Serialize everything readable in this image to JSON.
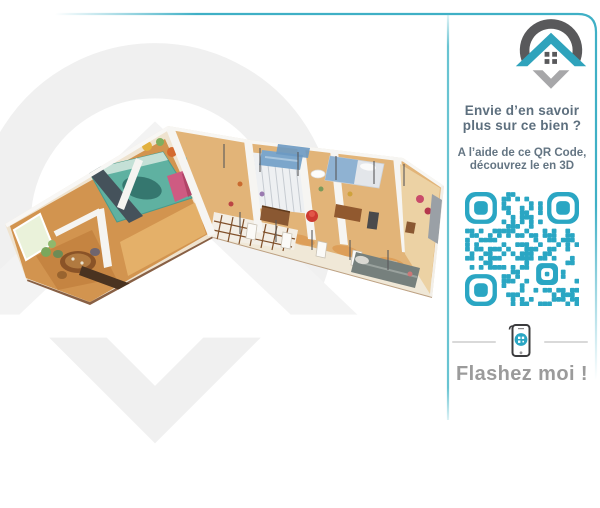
{
  "brand": {
    "logo_icon": "map-pin-house-logo"
  },
  "colors": {
    "accent_teal": "#2fa3bc",
    "qr_teal": "#2aa6c3",
    "logo_dark_gray": "#59595b",
    "logo_light_gray": "#a7a7a9",
    "text_slate": "#5d6f7e",
    "cta_gray": "#9b9b9b"
  },
  "main": {
    "illustration": "3d-dollhouse-apartment-floorplan"
  },
  "panel": {
    "headline": {
      "line1": "Envie d’en savoir",
      "line2": "plus sur ce bien ?"
    },
    "subtext": {
      "line1": "A l’aide de ce QR Code,",
      "line2": "découvrez le en 3D"
    },
    "qr": {
      "icon": "qr-code",
      "modules": 25,
      "seed": 12,
      "color": "#2aa6c3"
    },
    "phone_icon": "smartphone-scan-icon",
    "cta": "Flashez moi !"
  }
}
